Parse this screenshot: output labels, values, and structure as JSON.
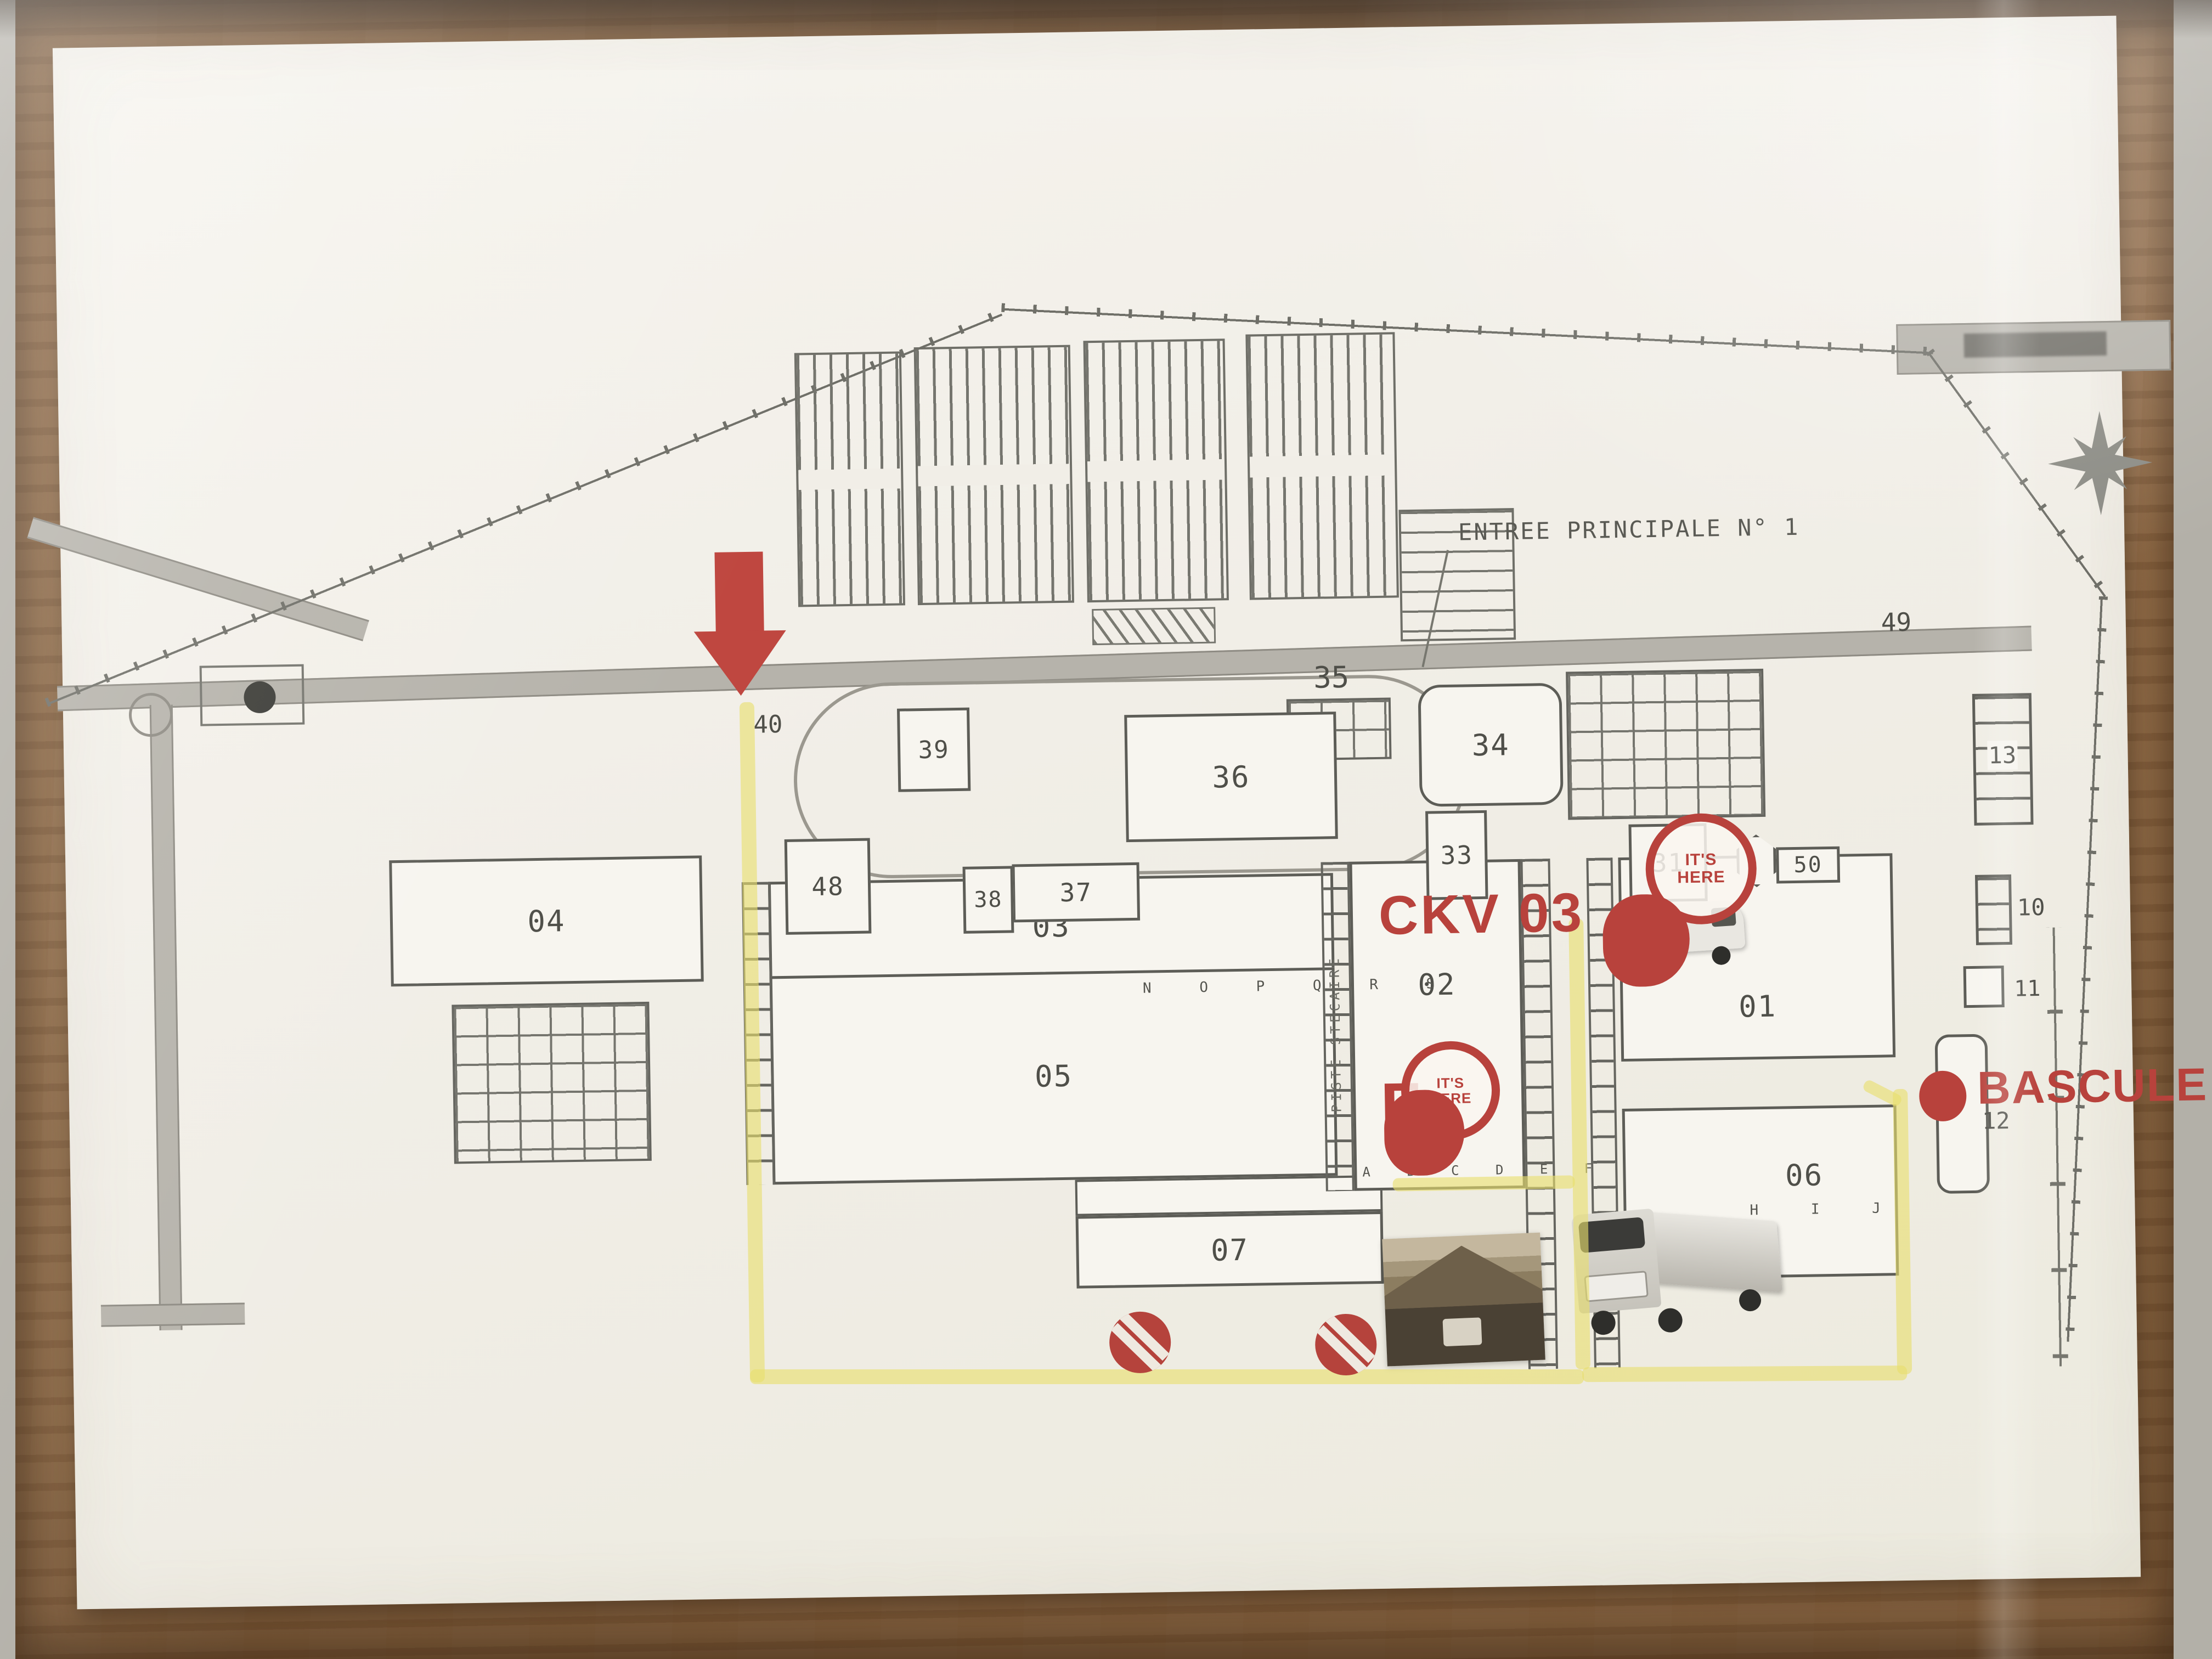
{
  "map": {
    "entrance_label": "ENTREE PRINCIPALE N° 1",
    "annotations": {
      "ckv": "CKV 03",
      "its_here_1": "IT'S\nHERE",
      "its_here_2": "IT'S\nHERE",
      "f_marker": "F",
      "bascule": "BASCULE"
    },
    "buildings": {
      "b01": "01",
      "b02": "02",
      "b03": "03",
      "b04": "04",
      "b05": "05",
      "b06": "06",
      "b07": "07",
      "b10": "10",
      "b11": "11",
      "b12": "12",
      "b13": "13",
      "b31": "31",
      "b33": "33",
      "b34": "34",
      "b35": "35",
      "b36": "36",
      "b37": "37",
      "b38": "38",
      "b39": "39",
      "b40": "40",
      "b48": "48",
      "b49": "49",
      "b50": "50"
    },
    "dock_letters_row_03": "N  O  P  Q  R  S",
    "dock_letters_row_05": "A  B  C  D  E  F",
    "dock_letters_row_06": "H   I   J",
    "side_text_vertical": "PISTE STECAIRE",
    "colors": {
      "route_highlight": "#e9df6e",
      "annotation_red": "#b8423c",
      "plan_line_gray": "#5d5d57",
      "paper": "#f2efe8",
      "board_wood": "#94704c"
    }
  }
}
